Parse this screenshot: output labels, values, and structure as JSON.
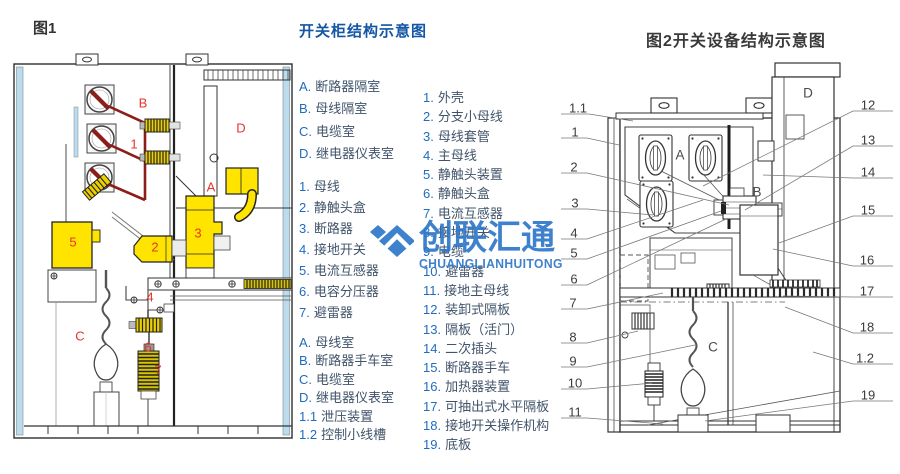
{
  "header": {
    "fig1_tag": "图1",
    "fig1_title": "开关柜结构示意图",
    "fig2_title": "图2开关设备结构示意图"
  },
  "legend_fig1": {
    "compartments": [
      {
        "n": "A.",
        "t": "断路器隔室"
      },
      {
        "n": "B.",
        "t": "母线隔室"
      },
      {
        "n": "C.",
        "t": "电缆室"
      },
      {
        "n": "D.",
        "t": "继电器仪表室"
      }
    ],
    "parts": [
      {
        "n": "1.",
        "t": "母线"
      },
      {
        "n": "2.",
        "t": "静触头盒"
      },
      {
        "n": "3.",
        "t": "断路器"
      },
      {
        "n": "4.",
        "t": "接地开关"
      },
      {
        "n": "5.",
        "t": "电流互感器"
      },
      {
        "n": "6.",
        "t": "电容分压器"
      },
      {
        "n": "7.",
        "t": "避雷器"
      }
    ]
  },
  "legend_fig2": {
    "compartments": [
      {
        "n": "A.",
        "t": "母线室"
      },
      {
        "n": "B.",
        "t": "断路器手车室"
      },
      {
        "n": "C.",
        "t": "电缆室"
      },
      {
        "n": "D.",
        "t": "继电器仪表室"
      },
      {
        "n": "1.1",
        "t": "泄压装置"
      },
      {
        "n": "1.2",
        "t": "控制小线槽"
      }
    ],
    "parts": [
      {
        "n": "1.",
        "t": "外壳"
      },
      {
        "n": "2.",
        "t": "分支小母线"
      },
      {
        "n": "3.",
        "t": "母线套管"
      },
      {
        "n": "4.",
        "t": "主母线"
      },
      {
        "n": "5.",
        "t": "静触头装置"
      },
      {
        "n": "6.",
        "t": "静触头盒"
      },
      {
        "n": "7.",
        "t": "电流互感器"
      },
      {
        "n": "8.",
        "t": "接地开关"
      },
      {
        "n": "9.",
        "t": "电缆"
      },
      {
        "n": "10.",
        "t": "避雷器"
      },
      {
        "n": "11.",
        "t": "接地主母线"
      },
      {
        "n": "12.",
        "t": "装卸式隔板"
      },
      {
        "n": "13.",
        "t": "隔板（活门）"
      },
      {
        "n": "14.",
        "t": "二次插头"
      },
      {
        "n": "15.",
        "t": "断路器手车"
      },
      {
        "n": "16.",
        "t": "加热器装置"
      },
      {
        "n": "17.",
        "t": "可抽出式水平隔板"
      },
      {
        "n": "18.",
        "t": "接地开关操作机构"
      },
      {
        "n": "19.",
        "t": "底板"
      }
    ]
  },
  "fig1": {
    "annotations": [
      {
        "t": "B",
        "x": 135,
        "y": 55,
        "cls": "red"
      },
      {
        "t": "D",
        "x": 233,
        "y": 80,
        "cls": "red"
      },
      {
        "t": "1",
        "x": 126,
        "y": 96,
        "cls": "red"
      },
      {
        "t": "A",
        "x": 203,
        "y": 139,
        "cls": "red"
      },
      {
        "t": "5",
        "x": 65,
        "y": 194,
        "cls": "red"
      },
      {
        "t": "3",
        "x": 190,
        "y": 185,
        "cls": "red"
      },
      {
        "t": "2",
        "x": 147,
        "y": 199,
        "cls": "red"
      },
      {
        "t": "4",
        "x": 142,
        "y": 249,
        "cls": "red"
      },
      {
        "t": "C",
        "x": 72,
        "y": 288,
        "cls": "red"
      },
      {
        "t": "6",
        "x": 140,
        "y": 299,
        "cls": "red"
      },
      {
        "t": "7",
        "x": 150,
        "y": 322,
        "cls": "red"
      }
    ]
  },
  "fig2": {
    "annotations": [
      {
        "t": "1.1",
        "x": 25,
        "y": 55,
        "cls": "dark"
      },
      {
        "t": "1",
        "x": 22,
        "y": 79,
        "cls": "dark"
      },
      {
        "t": "2",
        "x": 21,
        "y": 114,
        "cls": "dark"
      },
      {
        "t": "3",
        "x": 22,
        "y": 150,
        "cls": "dark"
      },
      {
        "t": "4",
        "x": 21,
        "y": 180,
        "cls": "dark"
      },
      {
        "t": "5",
        "x": 21,
        "y": 200,
        "cls": "dark"
      },
      {
        "t": "6",
        "x": 21,
        "y": 226,
        "cls": "dark"
      },
      {
        "t": "7",
        "x": 20,
        "y": 250,
        "cls": "dark"
      },
      {
        "t": "8",
        "x": 20,
        "y": 284,
        "cls": "dark"
      },
      {
        "t": "9",
        "x": 20,
        "y": 308,
        "cls": "dark"
      },
      {
        "t": "10",
        "x": 22,
        "y": 330,
        "cls": "dark"
      },
      {
        "t": "11",
        "x": 22,
        "y": 359,
        "cls": "dark"
      },
      {
        "t": "12",
        "x": 315,
        "y": 52,
        "cls": "dark"
      },
      {
        "t": "13",
        "x": 315,
        "y": 87,
        "cls": "dark"
      },
      {
        "t": "14",
        "x": 315,
        "y": 119,
        "cls": "dark"
      },
      {
        "t": "15",
        "x": 315,
        "y": 157,
        "cls": "dark"
      },
      {
        "t": "16",
        "x": 314,
        "y": 207,
        "cls": "dark"
      },
      {
        "t": "17",
        "x": 314,
        "y": 238,
        "cls": "dark"
      },
      {
        "t": "18",
        "x": 314,
        "y": 274,
        "cls": "dark"
      },
      {
        "t": "1.2",
        "x": 312,
        "y": 305,
        "cls": "dark"
      },
      {
        "t": "19",
        "x": 315,
        "y": 342,
        "cls": "dark"
      },
      {
        "t": "A",
        "x": 127,
        "y": 102,
        "cls": "letter"
      },
      {
        "t": "B",
        "x": 204,
        "y": 139,
        "cls": "letter"
      },
      {
        "t": "C",
        "x": 160,
        "y": 294,
        "cls": "letter"
      },
      {
        "t": "D",
        "x": 255,
        "y": 40,
        "cls": "letter"
      }
    ]
  },
  "watermark": {
    "cn": "创联汇通",
    "en": "CHUANGLIANHUITONG"
  },
  "colors": {
    "accent_blue": "#1356a4",
    "list_number": "#1f6cc0",
    "list_text": "#41546b",
    "label_red": "#e8332a",
    "watermark_blue": "#2e77c9",
    "highlight_yellow": "#ffe400",
    "busbar_maroon": "#8c1d18",
    "panel_blue": "#bcdcee"
  }
}
